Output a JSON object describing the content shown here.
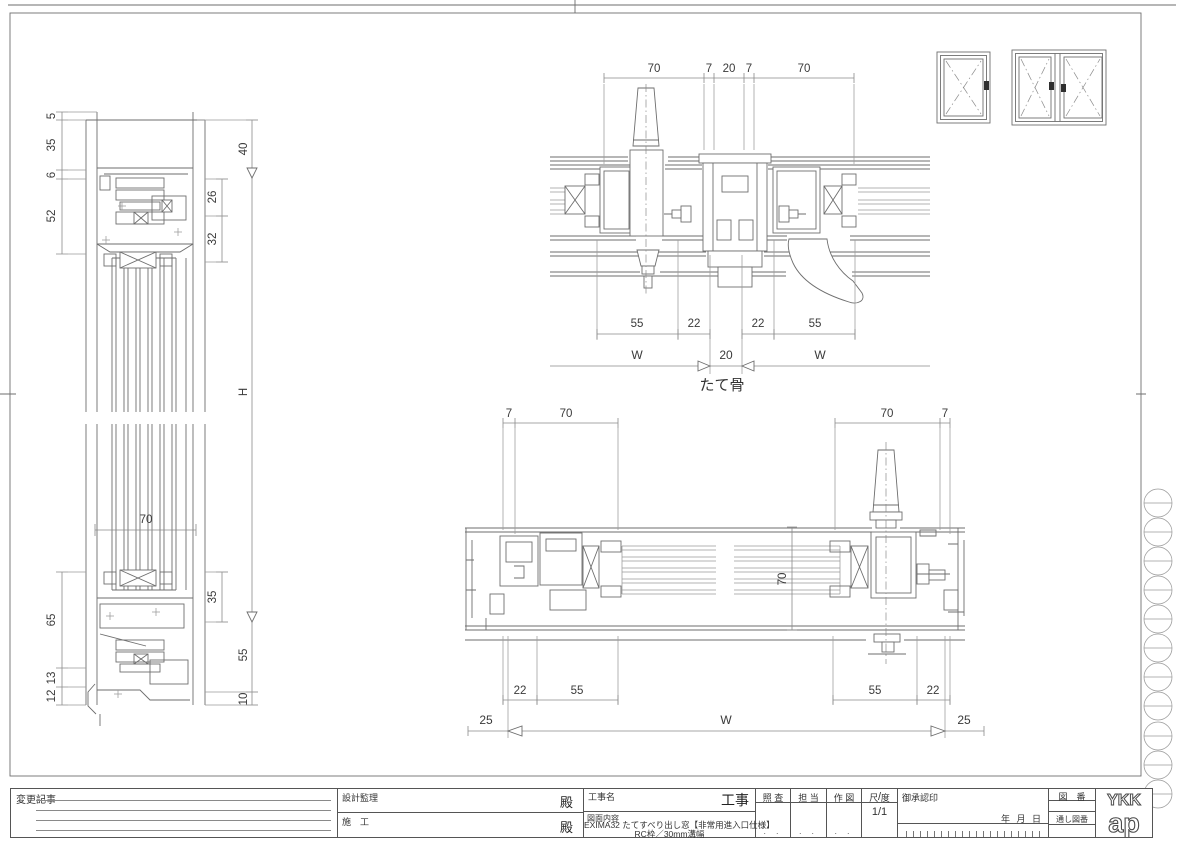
{
  "colors": {
    "line": "#6e6e6e",
    "text": "#3a3a3a",
    "border": "#555555"
  },
  "sections": {
    "vertical": {
      "dims_left": [
        "5",
        "35",
        "6",
        "52",
        "65",
        "13",
        "12"
      ],
      "dims_right_inner": [
        "26",
        "32",
        "35"
      ],
      "dims_right_outer": [
        "40",
        "H",
        "55",
        "10"
      ],
      "dim_width": "70"
    },
    "mullion": {
      "title": "たて骨",
      "dims_top": [
        "70",
        "7",
        "20",
        "7",
        "70"
      ],
      "dims_bottom": [
        "55",
        "22",
        "22",
        "55"
      ],
      "dims_width": [
        "W",
        "20",
        "W"
      ]
    },
    "horizontal": {
      "dims_top": [
        "7",
        "70",
        "70",
        "7"
      ],
      "dims_bottom": [
        "22",
        "55",
        "55",
        "22"
      ],
      "dims_width": [
        "25",
        "W",
        "25"
      ],
      "dim_height": "70"
    }
  },
  "title_block": {
    "change_label": "変更記事",
    "design_supervision_label": "設計監理",
    "construction_label": "施　工",
    "honorific_1": "殿",
    "honorific_2": "殿",
    "project_name_label": "工事名",
    "project_suffix": "工事",
    "drawing_content_label": "図面内容",
    "drawing_title_line1": "EXIMA32 たてすべり出し窓【非常用進入口仕様】",
    "drawing_title_line2": "RC枠／30mm溝幅",
    "check_label": "照 査",
    "charge_label": "担 当",
    "draft_label": "作 図",
    "scale_label": "尺 度",
    "scale_value": "1/1",
    "scale_slash": "/",
    "placeholder_dots": ". .",
    "approval_label": "御承認印",
    "date_label": "年 月 日",
    "drawing_no_label": "図　番",
    "serial_no_label": "通し図番",
    "logo_top": "YKK",
    "logo_bottom": "ap"
  }
}
